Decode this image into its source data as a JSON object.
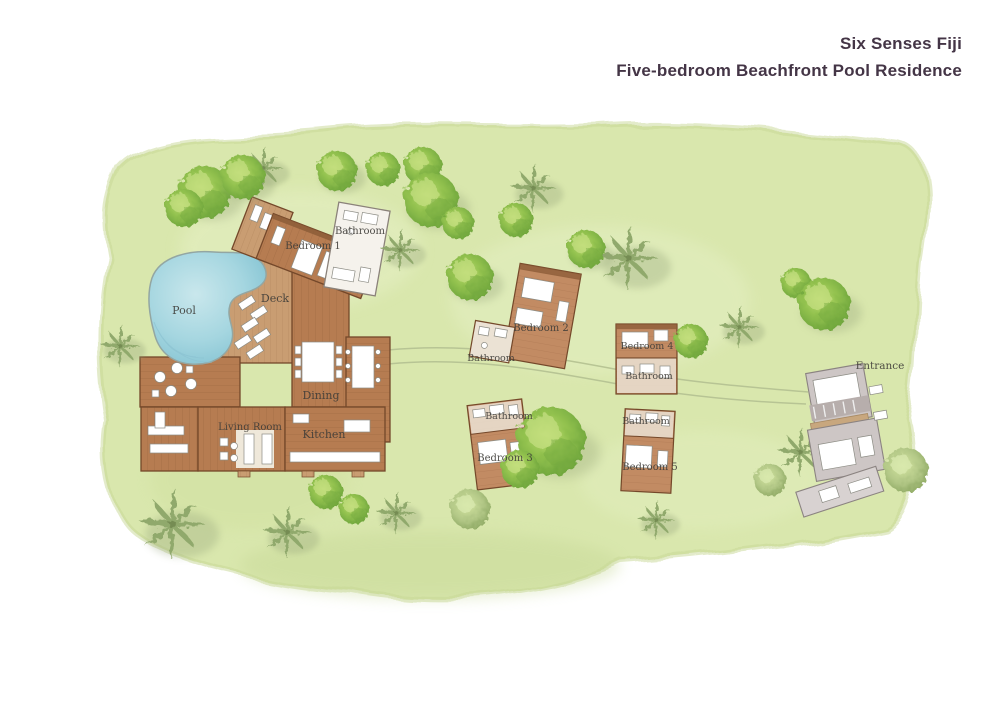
{
  "header": {
    "brand": "Six Senses Fiji",
    "subtitle": "Five-bedroom Beachfront Pool Residence"
  },
  "plan": {
    "labels": [
      {
        "id": "pool",
        "text": "Pool"
      },
      {
        "id": "deck",
        "text": "Deck"
      },
      {
        "id": "bedroom-1",
        "text": "Bedroom 1"
      },
      {
        "id": "bathroom-1",
        "text": "Bathroom"
      },
      {
        "id": "living-room",
        "text": "Living Room"
      },
      {
        "id": "dining",
        "text": "Dining"
      },
      {
        "id": "kitchen",
        "text": "Kitchen"
      },
      {
        "id": "bedroom-2",
        "text": "Bedroom 2"
      },
      {
        "id": "bathroom-2",
        "text": "Bathroom"
      },
      {
        "id": "bedroom-4",
        "text": "Bedroom 4"
      },
      {
        "id": "bathroom-4",
        "text": "Bathroom"
      },
      {
        "id": "bathroom-3",
        "text": "Bathroom"
      },
      {
        "id": "bedroom-3",
        "text": "Bedroom 3"
      },
      {
        "id": "bathroom-5",
        "text": "Bathroom"
      },
      {
        "id": "bedroom-5",
        "text": "Bedroom 5"
      },
      {
        "id": "entrance",
        "text": "Entrance"
      }
    ],
    "colors": {
      "lawn": "#d9e7ad",
      "lawn_edge": "#c8d897",
      "wood": "#b67c51",
      "wood_line": "#9a6540",
      "wood_dark": "#74482a",
      "deck": "#c99d72",
      "deck_line": "#b2855c",
      "pavilion": "#c28b63",
      "pavilion_line": "#a87450",
      "bath_annex": "#ebe2d4",
      "pool": "#a5d6e0",
      "pool_deep": "#7fc0d0",
      "pool_stroke": "#93a6a2",
      "bush": "#93c24f",
      "bush_light": "#c6e083",
      "bush_dark": "#74a83e",
      "palm": "#90a96c",
      "pale_tree": "#b3c887",
      "shadow": "#8f9e74",
      "path": "#b6c393",
      "entrance": "#cdc6c5",
      "entrance_stroke": "#8b8381",
      "title": "#443546",
      "label": "#3e3c38",
      "furn_stroke": "#8c8c84"
    }
  }
}
